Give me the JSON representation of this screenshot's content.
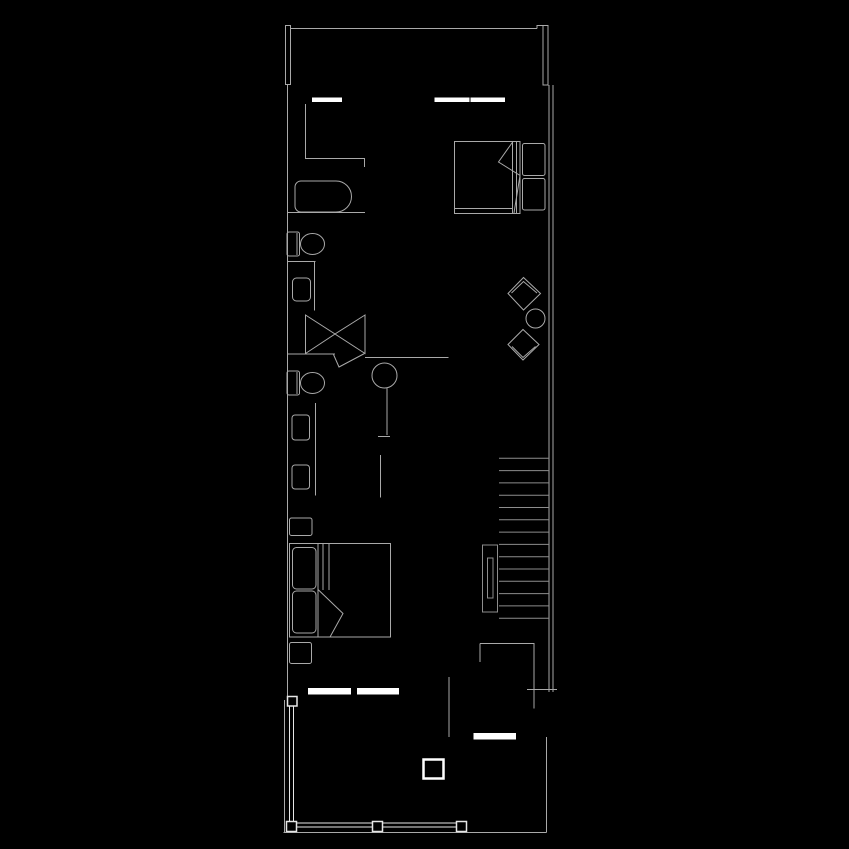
{
  "canvas": {
    "width": 849,
    "height": 849,
    "background": "#000000"
  },
  "palette": {
    "line": "#a9a9a9",
    "line_soft": "#8d8d8d",
    "bright": "#e6e6e6",
    "wall_fill": "#ffffff"
  },
  "legend": {
    "type": "architectural-floor-plan",
    "description": "narrow-apartment-plan-black-background-white-linework"
  },
  "elements": {
    "structure": [
      "top-balcony",
      "window-left",
      "window-right",
      "exterior-wall-left",
      "exterior-wall-right",
      "interior-wall-segments",
      "staircase",
      "stair-handrail",
      "storage-room",
      "terrace",
      "terrace-railing",
      "terrace-column"
    ],
    "furniture": [
      "double-bed-upper",
      "double-bed-lower",
      "pillow",
      "duvet-fold",
      "bathtub",
      "toilet-upper",
      "toilet-lower",
      "sink",
      "wardrobe-x-doors",
      "stool",
      "lounge-chair",
      "round-table",
      "nightstand",
      "drawer-unit"
    ]
  }
}
